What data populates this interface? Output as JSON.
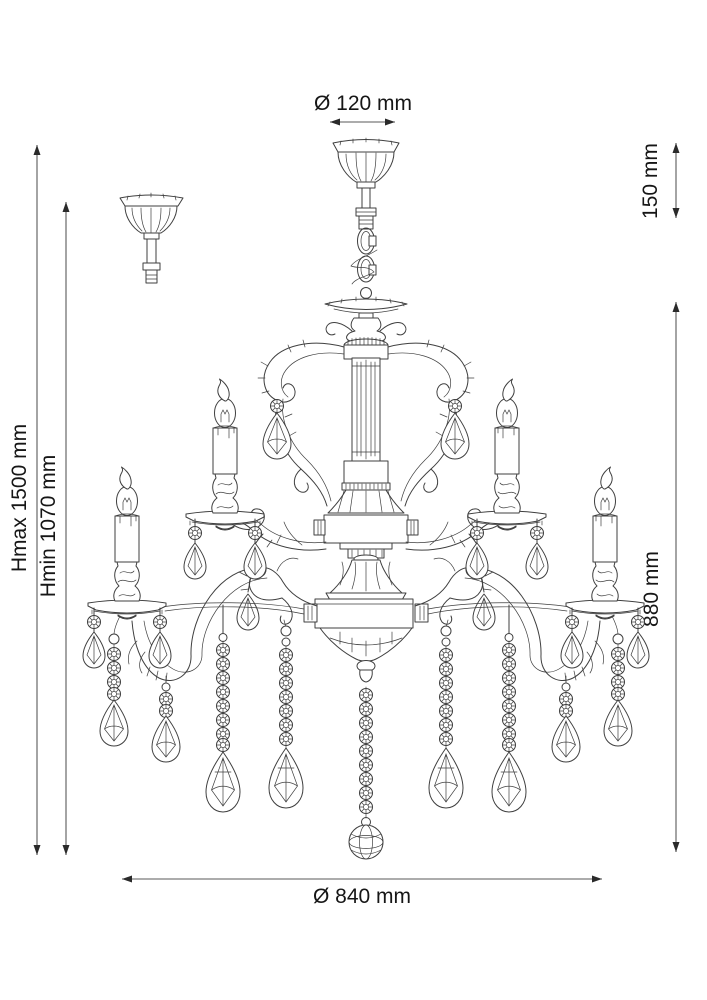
{
  "page": {
    "background": "#ffffff"
  },
  "dimensions": {
    "canopy_diameter": "Ø 120 mm",
    "suspension_height": "150 mm",
    "height_max": "Hmax 1500 mm",
    "height_min": "Hmin 1070 mm",
    "body_height": "880 mm",
    "body_diameter": "Ø 840 mm"
  },
  "figure": {
    "subject": "two-tier candle chandelier with crystal drops, technical dimension drawing",
    "visible_candles": 4,
    "detail_views": [
      "ceiling-canopy-side-view"
    ],
    "line_color": "#3f3f3f",
    "dimension_line_color": "#5a5a5a",
    "text_color": "#161616"
  }
}
